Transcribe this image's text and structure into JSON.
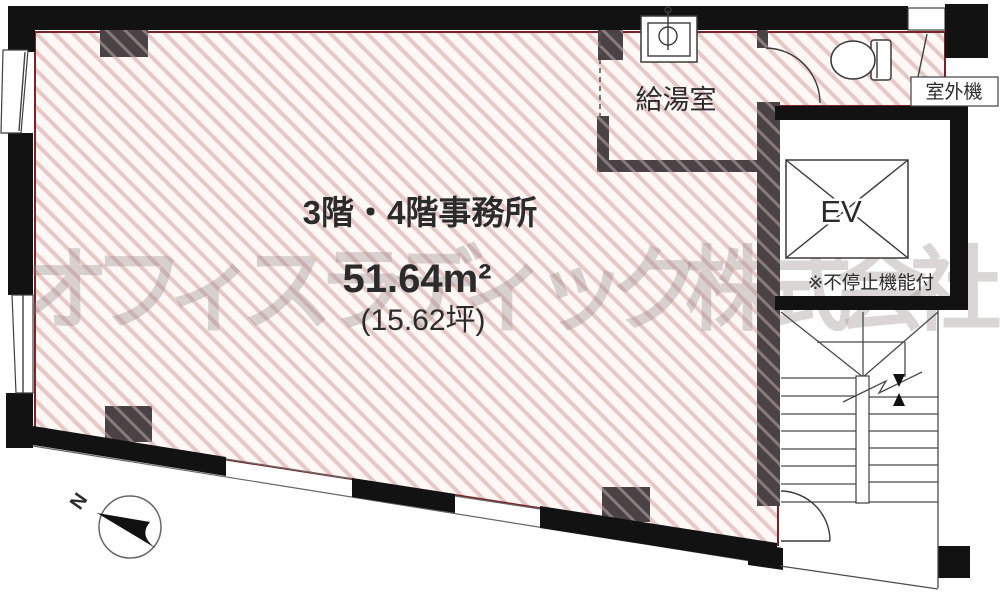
{
  "meta": {
    "type": "floor-plan",
    "floor_size_px": "1000x605"
  },
  "labels": {
    "title": "3階・4階事務所",
    "area_sqm": "51.64m²",
    "area_tsubo": "(15.62坪)",
    "kitchenette": "給湯室",
    "elevator": "EV",
    "elevator_note": "※不停止機能付",
    "outdoor_unit": "室外機",
    "north": "N"
  },
  "watermark": "オフィスラディック株式会社",
  "colors": {
    "hatch_bg": "#fdf7f5",
    "hatch_line": "#e8c8c6",
    "boundary": "#7d2327",
    "wall": "#121212",
    "column": "#4a4245",
    "column_line": "#a89a9a",
    "line": "#3f3f3f",
    "watermark": "#8d7f7e",
    "text": "#2b2b2b"
  }
}
